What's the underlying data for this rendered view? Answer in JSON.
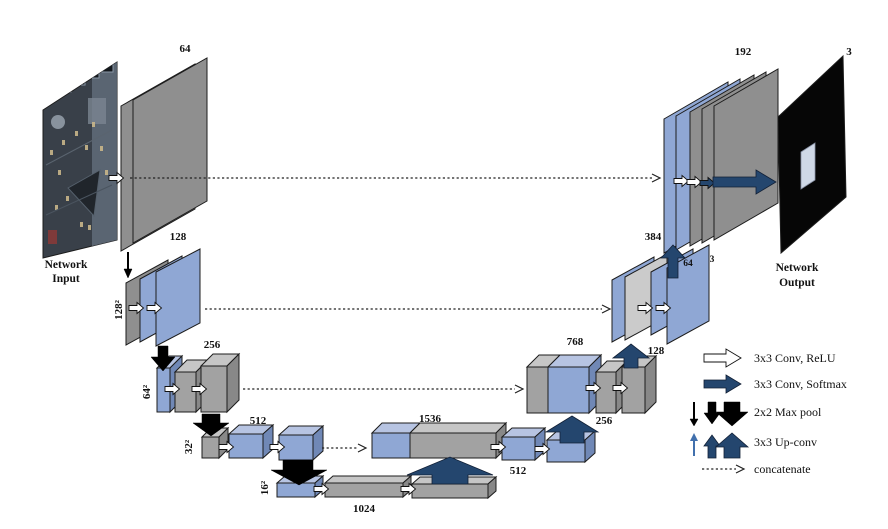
{
  "figure": {
    "input": {
      "caption_line1": "Network",
      "caption_line2": "Input"
    },
    "output": {
      "caption_line1": "Network",
      "caption_line2": "Output",
      "channels_label": "3"
    },
    "encoder": {
      "level1": {
        "channels": "64"
      },
      "level2": {
        "channels": "128",
        "resolution": "128²"
      },
      "level3": {
        "channels": "256",
        "resolution": "64²"
      },
      "level4": {
        "channels": "512",
        "resolution": "32²"
      },
      "level5": {
        "channels": "1024",
        "resolution": "16²"
      }
    },
    "decoder": {
      "bottleneck_concat": "1536",
      "level4_conv": "512",
      "level4_upconv": "256",
      "level4_concat": "768",
      "level3_upconv": "128",
      "level3_concat": "384",
      "level2_conv": "64",
      "level2_out": "3",
      "level1_concat": "192"
    },
    "legend": {
      "conv_relu": "3x3 Conv, ReLU",
      "conv_softmax": "3x3 Conv, Softmax",
      "maxpool": "2x2 Max pool",
      "upconv": "3x3 Up-conv",
      "concatenate": "concatenate"
    },
    "colors": {
      "feature_blue": "#8fa7d4",
      "feature_gray": "#9b9b9b",
      "arrow_navy": "#24466e",
      "arrow_black": "#000000"
    }
  }
}
